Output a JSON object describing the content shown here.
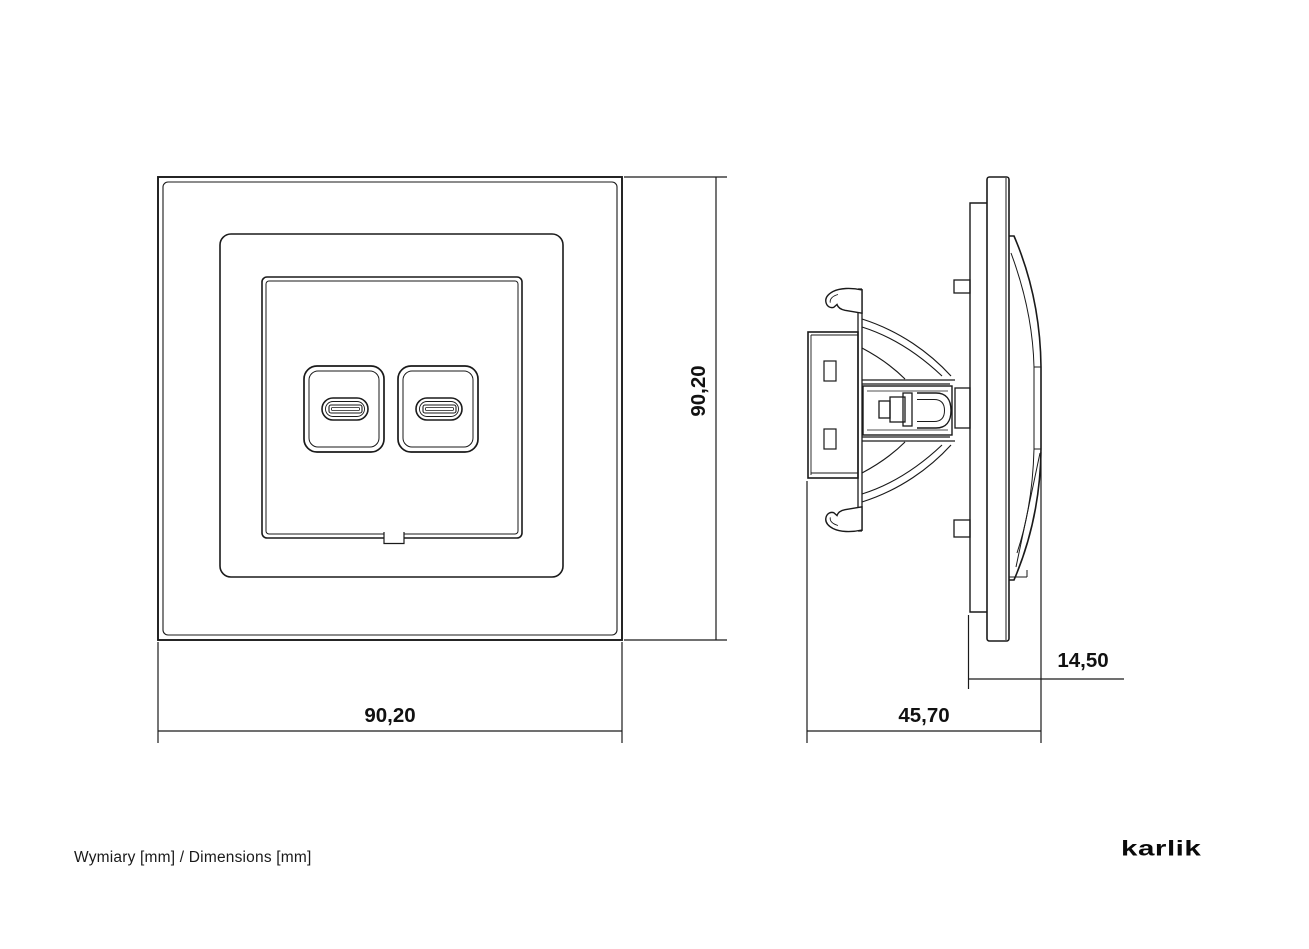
{
  "page": {
    "caption": "Wymiary [mm] / Dimensions [mm]",
    "logo_text": "karlik"
  },
  "front_view": {
    "name": "front view of USB-C double socket with frame",
    "width_mm": "90,20",
    "height_mm": "90,20"
  },
  "side_view": {
    "name": "side profile of socket mechanism with mounting claws",
    "total_depth_mm": "45,70",
    "front_protrusion_mm": "14,50"
  },
  "colors": {
    "line": "#1a1a1a",
    "text": "#111111",
    "background": "#ffffff"
  }
}
